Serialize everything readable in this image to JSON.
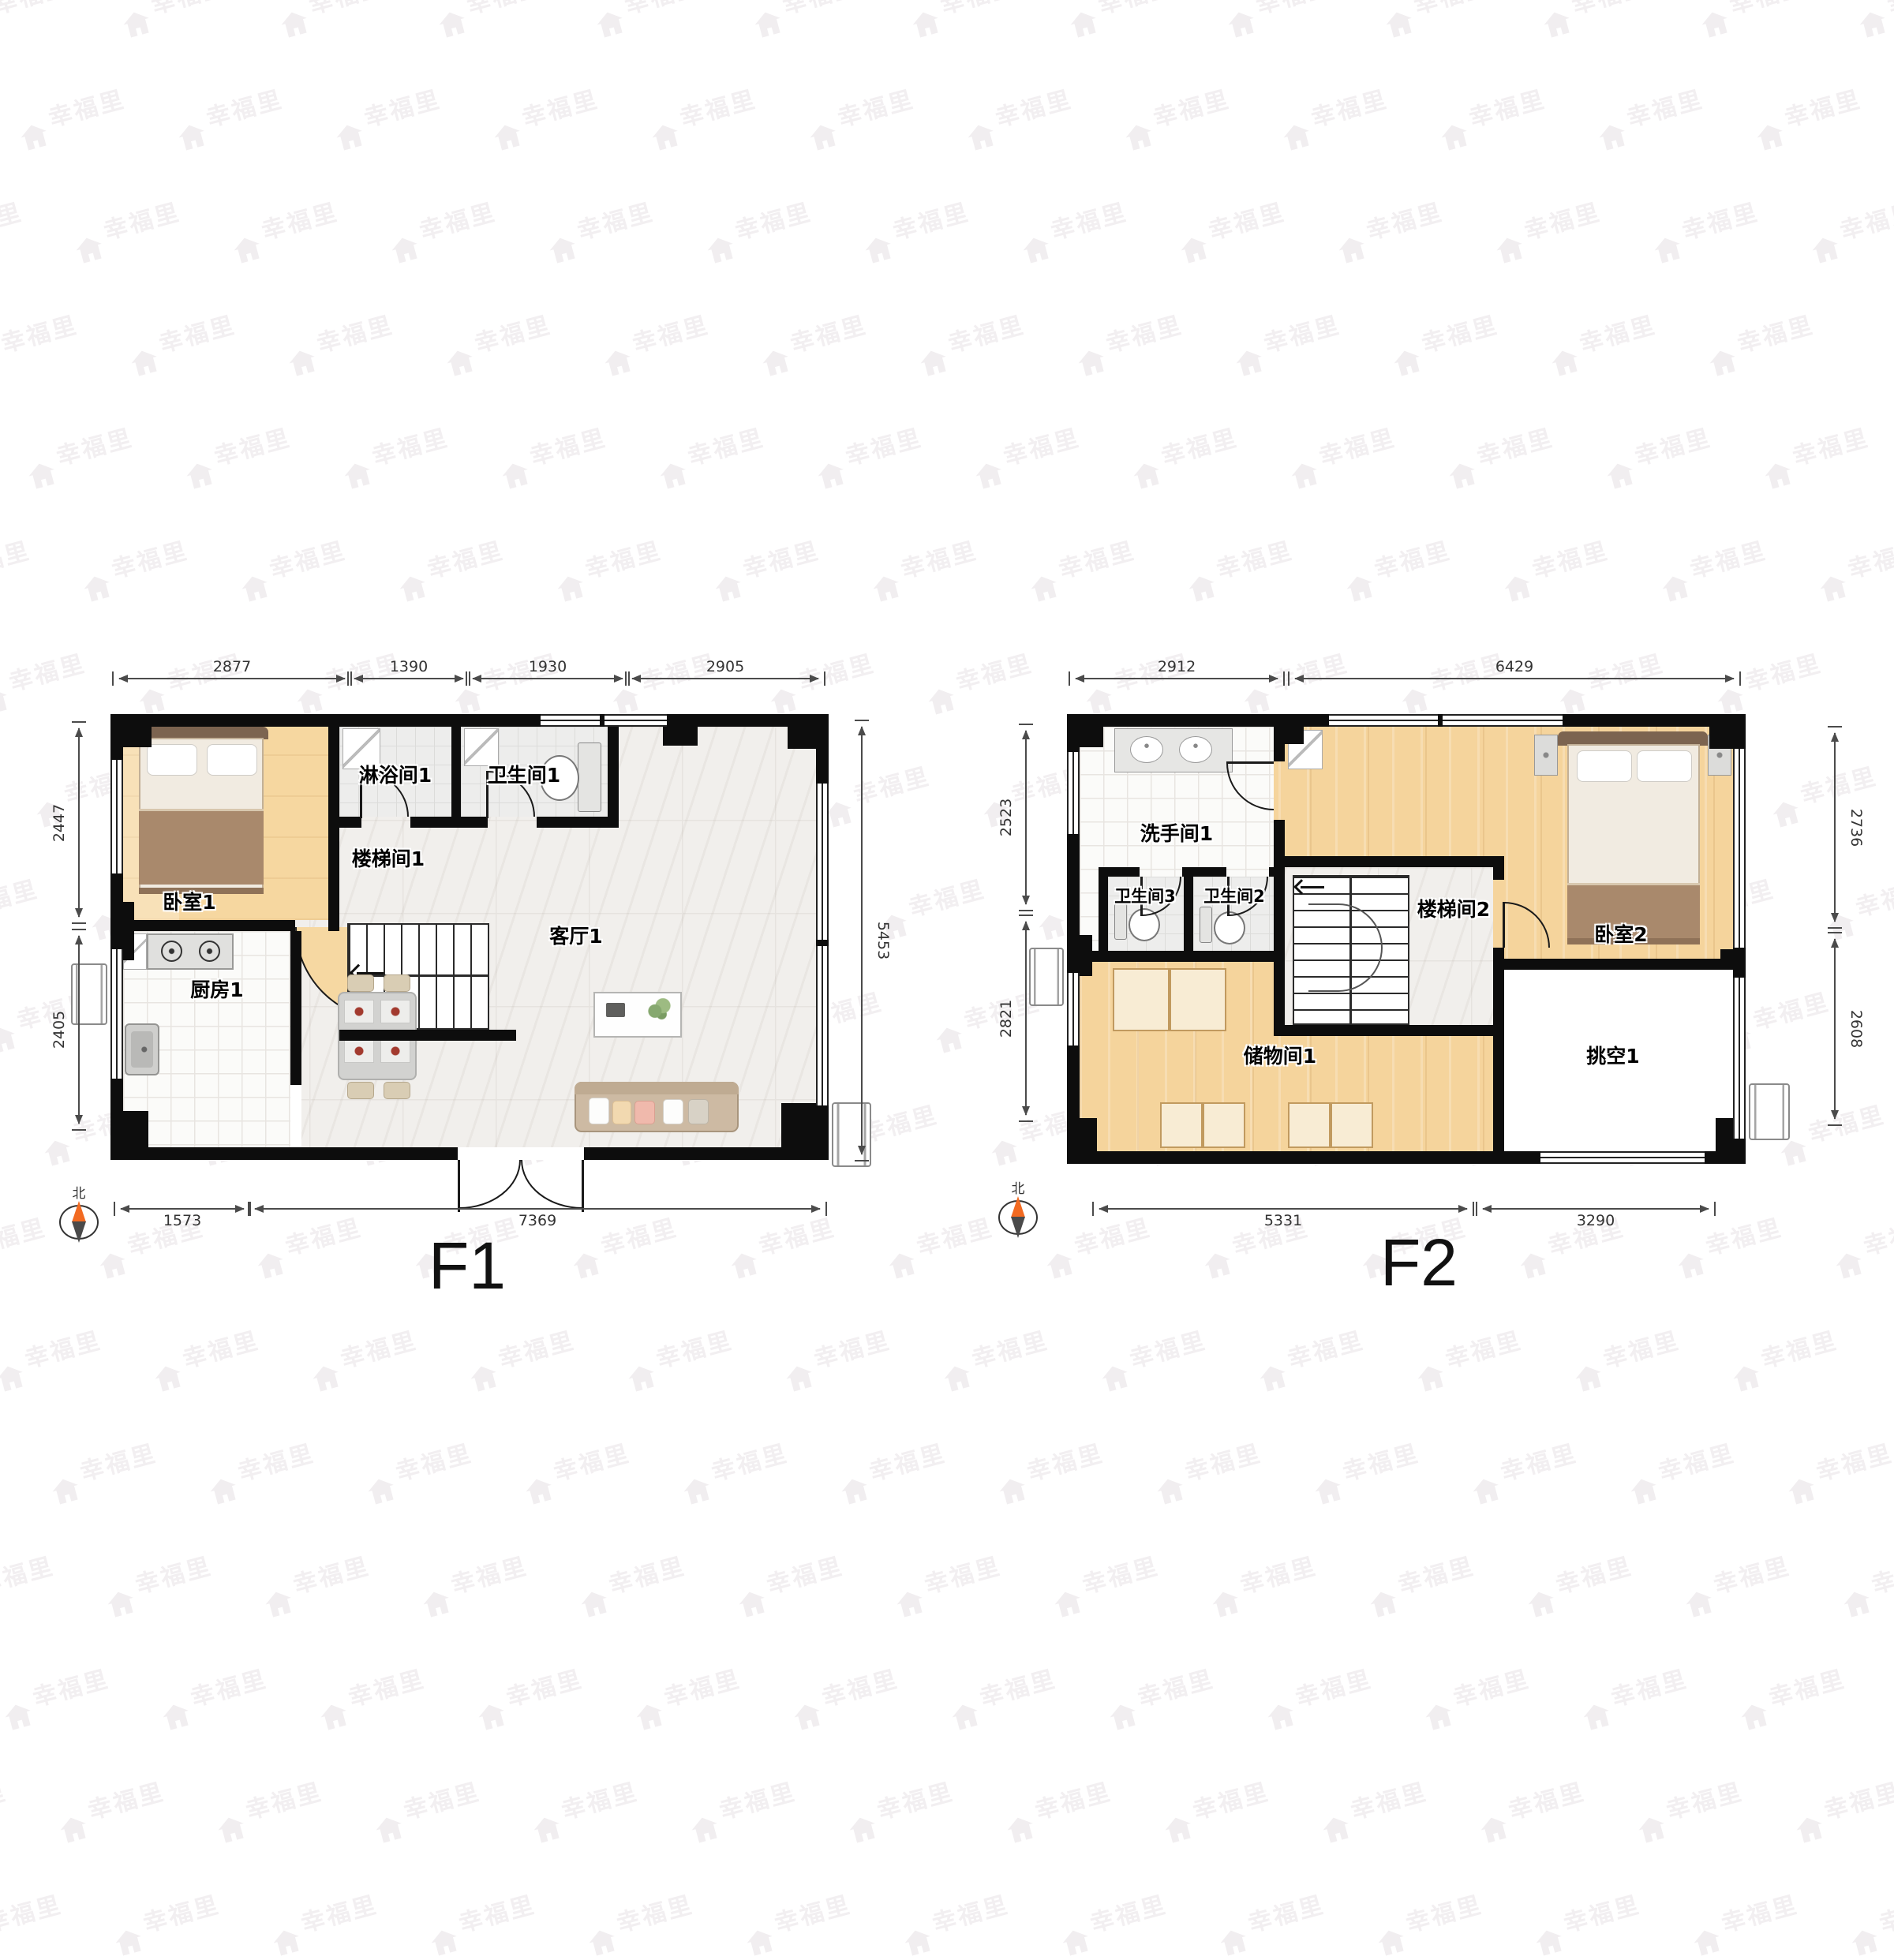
{
  "watermark": {
    "text": "幸福里"
  },
  "f1": {
    "title": "F1",
    "compass_label": "北",
    "rooms": {
      "bedroom1": "卧室1",
      "kitchen1": "厨房1",
      "shower1": "淋浴间1",
      "toilet1": "卫生间1",
      "stair1": "楼梯间1",
      "living1": "客厅1"
    },
    "dims": {
      "top": [
        "2877",
        "1390",
        "1930",
        "2905"
      ],
      "left": [
        "2447",
        "2405"
      ],
      "right": [
        "5453"
      ],
      "bottom": [
        "1573",
        "7369"
      ]
    }
  },
  "f2": {
    "title": "F2",
    "compass_label": "北",
    "rooms": {
      "washroom1": "洗手间1",
      "toilet3": "卫生间3",
      "toilet2": "卫生间2",
      "stair2": "楼梯间2",
      "bedroom2": "卧室2",
      "storage1": "储物间1",
      "void1": "挑空1"
    },
    "dims": {
      "top": [
        "2912",
        "6429"
      ],
      "left": [
        "2523",
        "2821"
      ],
      "right": [
        "2736",
        "2608"
      ],
      "bottom": [
        "5331",
        "3290"
      ]
    }
  }
}
